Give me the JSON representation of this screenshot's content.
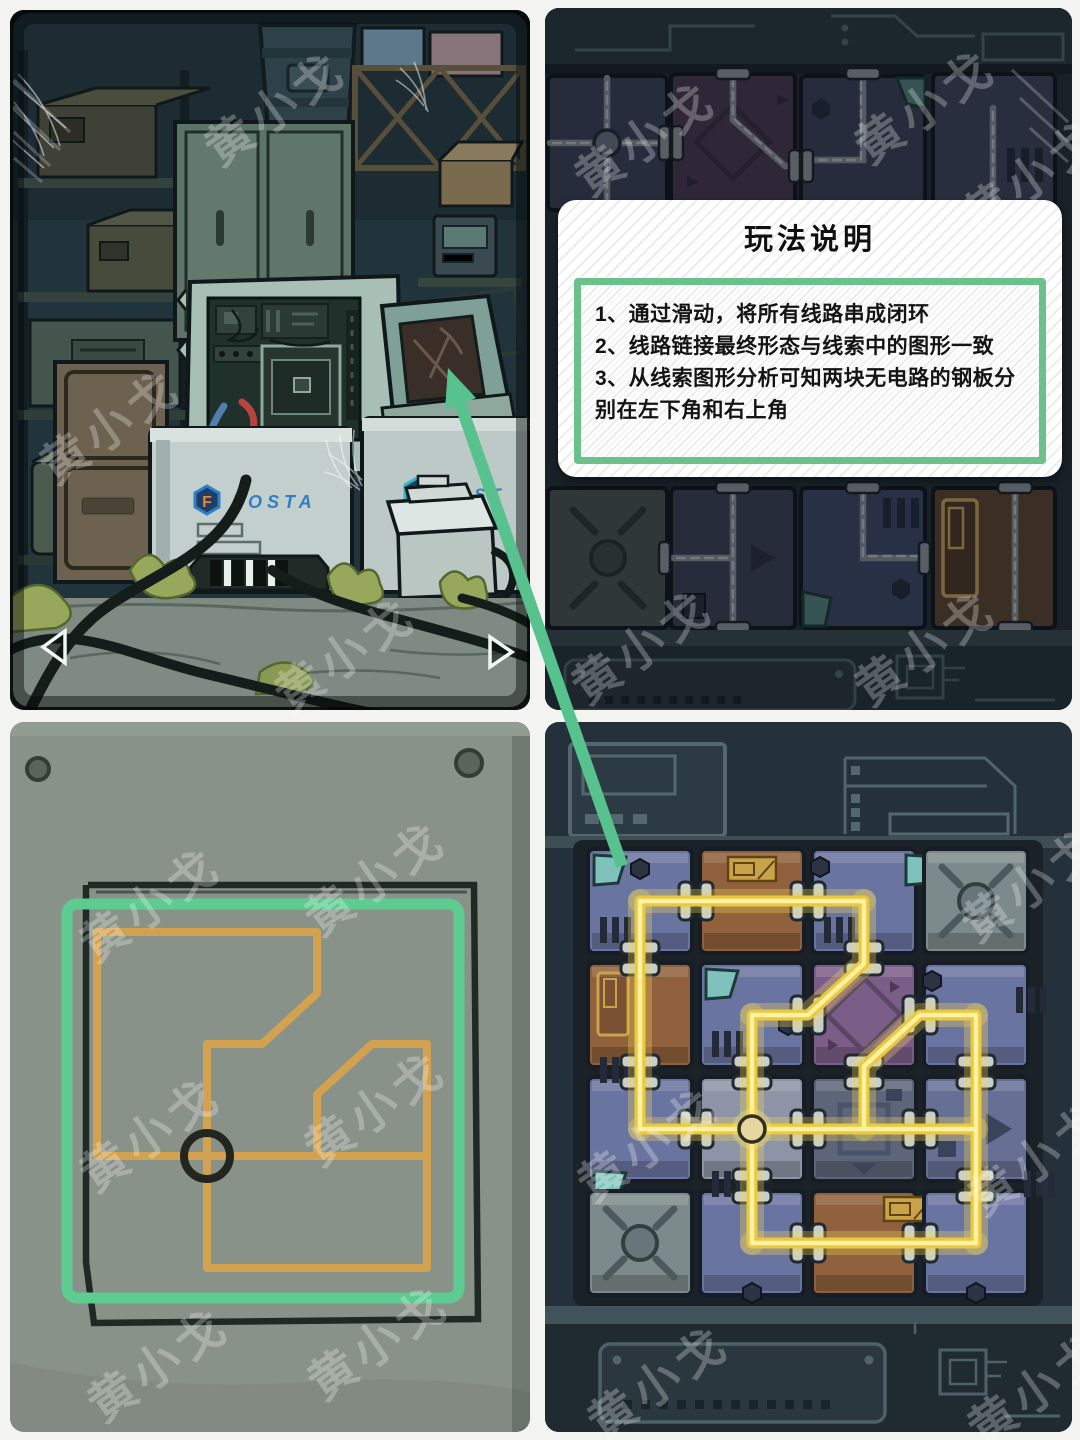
{
  "watermark": {
    "text": "黄小戈",
    "spots": [
      {
        "x": 285,
        "y": 122,
        "r": -35
      },
      {
        "x": 355,
        "y": 668,
        "r": -35
      },
      {
        "x": 120,
        "y": 440,
        "r": -35
      },
      {
        "x": 655,
        "y": 152,
        "r": -35
      },
      {
        "x": 935,
        "y": 120,
        "r": -35
      },
      {
        "x": 1042,
        "y": 190,
        "r": -35
      },
      {
        "x": 652,
        "y": 660,
        "r": -35
      },
      {
        "x": 935,
        "y": 662,
        "r": -35
      },
      {
        "x": 160,
        "y": 918,
        "r": -35
      },
      {
        "x": 385,
        "y": 892,
        "r": -35
      },
      {
        "x": 160,
        "y": 1148,
        "r": -35
      },
      {
        "x": 385,
        "y": 1122,
        "r": -35
      },
      {
        "x": 168,
        "y": 1378,
        "r": -35
      },
      {
        "x": 388,
        "y": 1356,
        "r": -35
      },
      {
        "x": 1042,
        "y": 898,
        "r": -35
      },
      {
        "x": 658,
        "y": 1158,
        "r": -35
      },
      {
        "x": 1048,
        "y": 1172,
        "r": -35
      },
      {
        "x": 668,
        "y": 1396,
        "r": -35
      },
      {
        "x": 1048,
        "y": 1402,
        "r": -35
      }
    ]
  },
  "colors": {
    "green": "#58c28f",
    "modal_green": "#6cc08b",
    "wire": "#e9c93f",
    "wire_hi": "#fff1a2",
    "wire_glow": "rgba(250,220,90,0.30)",
    "orange": "#d2a250",
    "paper": "#899288",
    "ink": "#202b26",
    "teal": "#7fc2bc",
    "posta_blue": "#2f7fc6",
    "posta_orange": "#e8862e",
    "plate_blue": "#6a74a0",
    "plate_blue2": "#667095",
    "plate_brown": "#90613c",
    "plate_purple": "#7b5e88",
    "plate_gray": "#7d8a8b",
    "plate_steel": "#8d94a6",
    "plate_dark": "#5d6678",
    "clamp": "#c9cfc7",
    "ball": "#e6d79f"
  },
  "scene": {
    "brand_f": "F",
    "brand_rest": "OSTA",
    "brand2_f": "F",
    "brand2_rest": "OST",
    "nav_left_icon": "left-triangle",
    "nav_right_icon": "right-triangle"
  },
  "instructions": {
    "title": "玩法说明",
    "line1": "1、通过滑动，将所有线路串成闭环",
    "line2": "2、线路链接最终形态与线索中的图形一致",
    "line3": "3、从线索图形分析可知两块无电路的钢板分别在左下角和右上角"
  },
  "puzzle": {
    "rows": 4,
    "cols": 4,
    "wire": {
      "segments": [
        [
          [
            0,
            0
          ],
          [
            2,
            0
          ]
        ],
        [
          [
            0,
            0
          ],
          [
            0,
            2
          ]
        ],
        [
          [
            2,
            0
          ],
          [
            2,
            0.55
          ],
          [
            1.5,
            1
          ],
          [
            1,
            1
          ]
        ],
        [
          [
            1,
            1
          ],
          [
            1,
            3
          ]
        ],
        [
          [
            1,
            3
          ],
          [
            3,
            3
          ]
        ],
        [
          [
            3,
            3
          ],
          [
            3,
            1
          ]
        ],
        [
          [
            3,
            1
          ],
          [
            2.5,
            1
          ],
          [
            2,
            1.45
          ],
          [
            2,
            2
          ]
        ],
        [
          [
            0,
            2
          ],
          [
            3,
            2
          ]
        ]
      ],
      "crossing": [
        1,
        2
      ],
      "clamps": [
        [
          0.5,
          0
        ],
        [
          1.5,
          0
        ],
        [
          0,
          0.5
        ],
        [
          0,
          1.5
        ],
        [
          2,
          0.5
        ],
        [
          1.5,
          1
        ],
        [
          1,
          1.5
        ],
        [
          1,
          2.5
        ],
        [
          1.5,
          3
        ],
        [
          2.5,
          3
        ],
        [
          3,
          2.5
        ],
        [
          3,
          1.5
        ],
        [
          2.5,
          1
        ],
        [
          2,
          1.5
        ],
        [
          0.5,
          2
        ],
        [
          1.5,
          2
        ],
        [
          2.5,
          2
        ]
      ]
    },
    "plates": [
      [
        {
          "color": "blue",
          "teal": "tl",
          "vent": "bl",
          "bolt": "tc"
        },
        {
          "color": "brown",
          "plaque": "tc"
        },
        {
          "color": "blue",
          "teal": "tr",
          "vent": "bl",
          "bolt": "tl"
        },
        {
          "color": "gray",
          "scratch": true
        }
      ],
      [
        {
          "color": "brown",
          "door": "tl"
        },
        {
          "color": "blue",
          "teal": "tl",
          "vent": "bl",
          "bolt": "cr"
        },
        {
          "color": "purple",
          "diamond": true
        },
        {
          "color": "blue",
          "vent": "cr",
          "bolt": "tl"
        }
      ],
      [
        {
          "color": "blue",
          "vent": "tl",
          "teal": "bl"
        },
        {
          "color": "steel"
        },
        {
          "color": "dark",
          "square": true
        },
        {
          "color": "blue2",
          "arrow": true
        }
      ],
      [
        {
          "color": "gray",
          "scratch": true
        },
        {
          "color": "blue",
          "vent": "tl",
          "bolt": "bc"
        },
        {
          "color": "brown",
          "plaque": "tr"
        },
        {
          "color": "blue",
          "vent": "tr",
          "bolt": "bc"
        }
      ]
    ]
  },
  "clue": {
    "note": "orange loop drawing on pinned paper, circle marks the crossing",
    "circle": [
      1,
      2
    ]
  }
}
